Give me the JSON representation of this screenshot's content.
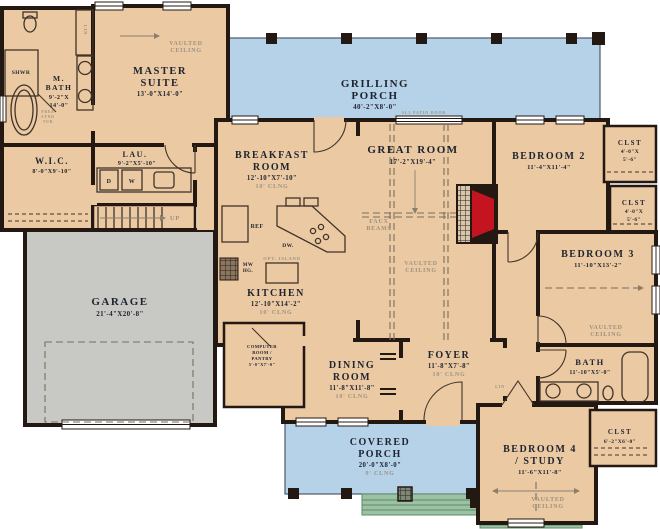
{
  "palette": {
    "room": "#ebc9a3",
    "porch": "#b6d2e8",
    "garage": "#c8c8c5",
    "wall": "#241812",
    "fireplace": "#c41420",
    "steps": "#9cc2a4",
    "label": "#1e2430",
    "note": "#9c9280"
  },
  "rooms": {
    "master": {
      "name1": "MASTER",
      "name2": "SUITE",
      "dims": "13'-0\"X14'-0\""
    },
    "m_bath": {
      "name1": "M.",
      "name2": "BATH",
      "dims1": "9'-2\"X",
      "dims2": "14'-0\""
    },
    "wic": {
      "name": "W.I.C.",
      "dims": "8'-0\"X9'-10\""
    },
    "lau": {
      "name": "LAU.",
      "dims": "9'-2\"X5'-10\""
    },
    "garage": {
      "name": "GARAGE",
      "dims": "21'-4\"X20'-8\""
    },
    "grilling_porch": {
      "name1": "GRILLING",
      "name2": "PORCH",
      "dims": "40'-2\"X8'-0\""
    },
    "breakfast": {
      "name1": "BREAKFAST",
      "name2": "ROOM",
      "dims": "12'-10\"X7'-10\"",
      "ceiling": "10' CLNG"
    },
    "kitchen": {
      "name": "KITCHEN",
      "dims": "12'-10\"X14'-2\"",
      "ceiling": "10' CLNG"
    },
    "great_room": {
      "name": "GREAT ROOM",
      "dims": "17'-2\"X19'-4\""
    },
    "bedroom2": {
      "name": "BEDROOM 2",
      "dims": "11'-4\"X11'-4\""
    },
    "clst_top": {
      "name": "CLST",
      "dims1": "4'-0\"X",
      "dims2": "5'-6\""
    },
    "clst_mid": {
      "name": "CLST",
      "dims1": "4'-0\"X",
      "dims2": "5'-6\""
    },
    "bedroom3": {
      "name": "BEDROOM 3",
      "dims": "11'-10\"X13'-2\""
    },
    "computer_room": {
      "name1": "COMPUTER",
      "name2": "ROOM /",
      "name3": "PANTRY",
      "dims": "5'-0\"X7'-0\""
    },
    "dining": {
      "name1": "DINING",
      "name2": "ROOM",
      "dims": "11'-8\"X11'-8\"",
      "ceiling": "10' CLNG"
    },
    "foyer": {
      "name": "FOYER",
      "dims": "11'-8\"X7'-8\"",
      "ceiling": "10' CLNG"
    },
    "bath": {
      "name": "BATH",
      "dims": "11'-10\"X5'-0\""
    },
    "covered_porch": {
      "name1": "COVERED",
      "name2": "PORCH",
      "dims": "20'-0\"X8'-0\"",
      "ceiling": "9' CLNG"
    },
    "bedroom4": {
      "name1": "BEDROOM 4",
      "name2": "/ STUDY",
      "dims": "11'-6\"X11'-8\""
    },
    "clst_br": {
      "name": "CLST",
      "dims": "6'-2\"X6'-0\""
    }
  },
  "annotations": {
    "vaulted1": "VAULTED",
    "vaulted2": "CEILING",
    "faux1": "FAUX",
    "faux2": "BEAMS",
    "patio_door": "SL3 PATIO DOOR",
    "ref": "REF",
    "dw": "DW.",
    "mw1": "MW",
    "mw2": "HG.",
    "opt_island": "OPT. ISLAND",
    "up": "UP",
    "lin": "LIN",
    "shwr": "SHWR",
    "free1": "FREE",
    "free2": "STND",
    "free3": "TUB",
    "washer": "W",
    "dryer": "D"
  }
}
